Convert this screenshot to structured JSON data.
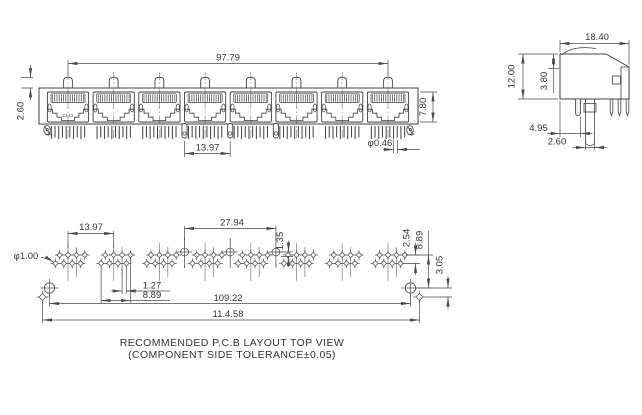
{
  "front_view": {
    "span": "97.79",
    "latch_height": "2.60",
    "port_height": "7.80",
    "post_pitch": "13.97",
    "pin_dia": "φ0.46",
    "marking": "CLCI"
  },
  "side_view": {
    "depth": "18.40",
    "height": "12.00",
    "flange": "3.80",
    "peg_pos": "4.95",
    "peg_dia": "2.60"
  },
  "pcb": {
    "hole_dia": "φ1.00",
    "group_pitch": "13.97",
    "post_pitch": "27.94",
    "post_offset": "1.35",
    "row_pitch": "2.54",
    "row_offset": "1.27",
    "group_span": "8.89",
    "edge_drop": "8.89",
    "hole_drop": "3.05",
    "mount_span": "109.22",
    "total_span": "11.4.58",
    "caption1": "RECOMMENDED P.C.B LAYOUT TOP VIEW",
    "caption2": "(COMPONENT SIDE TOLERANCE±0.05)"
  },
  "colors": {
    "line": "#3f3f3f",
    "dim": "#4a4a4a",
    "text": "#333333",
    "bg": "#ffffff"
  }
}
